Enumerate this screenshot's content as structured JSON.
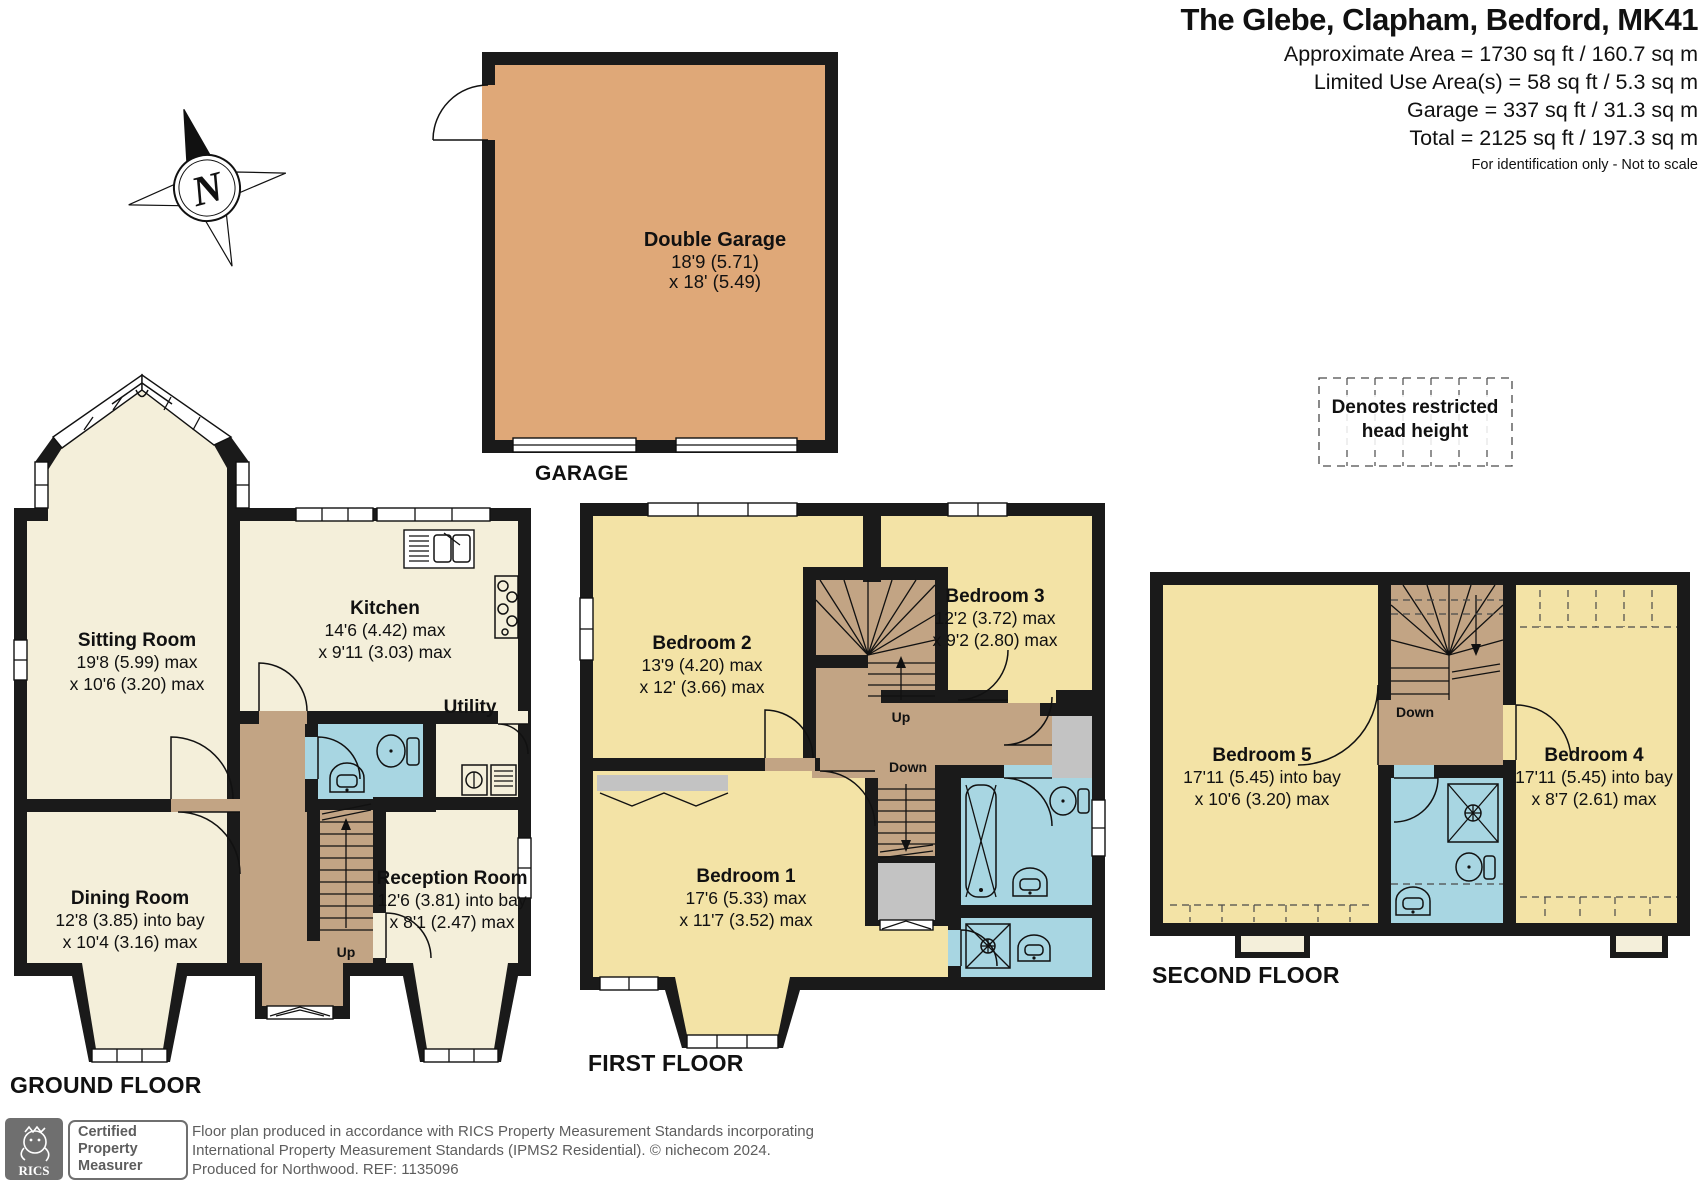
{
  "header": {
    "title": "The Glebe, Clapham, Bedford, MK41",
    "area_lines": [
      "Approximate Area = 1730 sq ft / 160.7 sq m",
      "Limited Use Area(s) = 58 sq ft / 5.3 sq m",
      "Garage = 337 sq ft / 31.3 sq m",
      "Total = 2125 sq ft / 197.3 sq m"
    ],
    "disclaimer": "For identification only - Not to scale"
  },
  "compass": {
    "north_label": "N"
  },
  "legend": {
    "line1": "Denotes restricted",
    "line2": "head height"
  },
  "floor_labels": {
    "garage": "GARAGE",
    "ground": "GROUND FLOOR",
    "first": "FIRST FLOOR",
    "second": "SECOND FLOOR"
  },
  "stairs": {
    "up": "Up",
    "down": "Down"
  },
  "rooms": {
    "double_garage": {
      "name": "Double Garage",
      "dim1": "18'9 (5.71)",
      "dim2": "x 18' (5.49)"
    },
    "sitting_room": {
      "name": "Sitting Room",
      "dim1": "19'8 (5.99) max",
      "dim2": "x 10'6 (3.20) max"
    },
    "kitchen": {
      "name": "Kitchen",
      "dim1": "14'6 (4.42) max",
      "dim2": "x 9'11 (3.03) max"
    },
    "utility": {
      "name": "Utility"
    },
    "dining_room": {
      "name": "Dining Room",
      "dim1": "12'8 (3.85) into bay",
      "dim2": "x 10'4 (3.16) max"
    },
    "reception_room": {
      "name": "Reception Room",
      "dim1": "12'6 (3.81) into bay",
      "dim2": "x 8'1 (2.47) max"
    },
    "bedroom_1": {
      "name": "Bedroom 1",
      "dim1": "17'6 (5.33) max",
      "dim2": "x 11'7 (3.52) max"
    },
    "bedroom_2": {
      "name": "Bedroom 2",
      "dim1": "13'9 (4.20) max",
      "dim2": "x 12' (3.66) max"
    },
    "bedroom_3": {
      "name": "Bedroom 3",
      "dim1": "12'2 (3.72) max",
      "dim2": "x 9'2 (2.80) max"
    },
    "bedroom_4": {
      "name": "Bedroom 4",
      "dim1": "17'11 (5.45) into bay",
      "dim2": "x 8'7 (2.61) max"
    },
    "bedroom_5": {
      "name": "Bedroom 5",
      "dim1": "17'11 (5.45) into bay",
      "dim2": "x 10'6 (3.20) max"
    }
  },
  "footer": {
    "rics_logo": "RICS",
    "badge": {
      "line1": "Certified",
      "line2": "Property",
      "line3": "Measurer"
    },
    "lines": [
      "Floor plan produced in accordance with RICS Property Measurement Standards incorporating",
      "International Property Measurement Standards (IPMS2 Residential).   © nichecom 2024.",
      "Produced for Northwood.   REF:  1135096"
    ]
  },
  "colors": {
    "wall": "#1a1a1a",
    "cream": "#f4efda",
    "yellow": "#f3e3a6",
    "tan": "#dfa878",
    "brown": "#c2a484",
    "blue": "#a8d6e2",
    "fixture_gray": "#c3c3c3",
    "footer_gray": "#5d5d5d"
  }
}
